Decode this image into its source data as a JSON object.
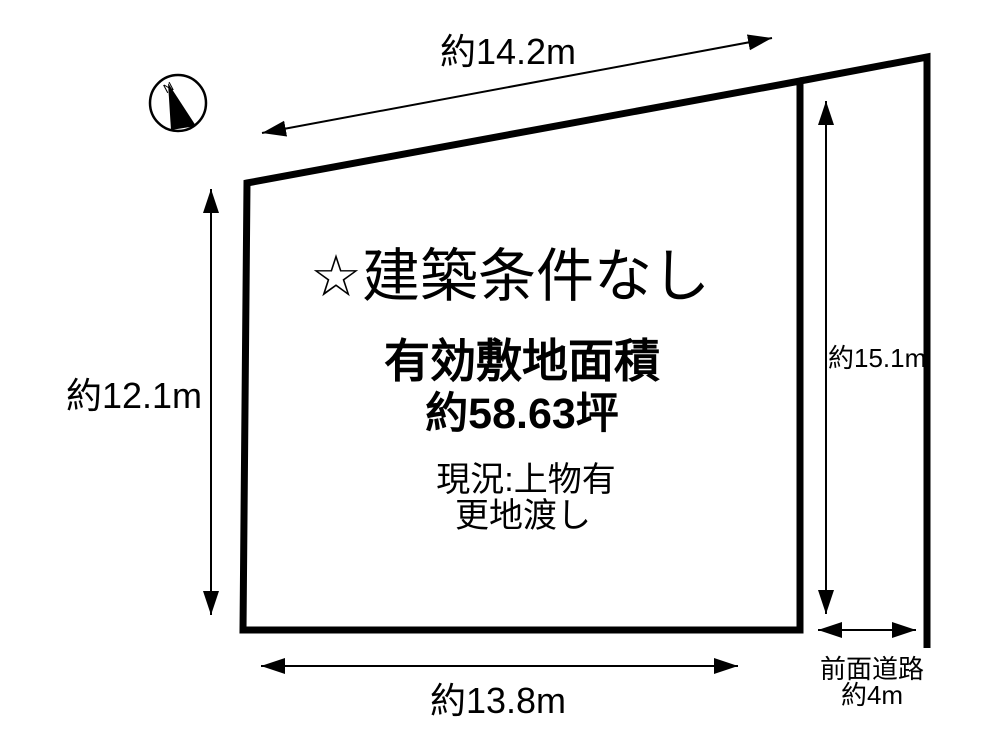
{
  "diagram": {
    "title": "☆建築条件なし",
    "area_label": "有効敷地面積",
    "area_value": "約58.63坪",
    "status_line1": "現況:上物有",
    "status_line2": "更地渡し",
    "dims": {
      "top": "約14.2m",
      "left": "約12.1m",
      "right": "約15.1m",
      "bottom": "約13.8m",
      "road_label": "前面道路",
      "road_width": "約4m"
    },
    "compass": {
      "north_label": "N"
    },
    "colors": {
      "line": "#000000",
      "background": "#ffffff"
    }
  }
}
